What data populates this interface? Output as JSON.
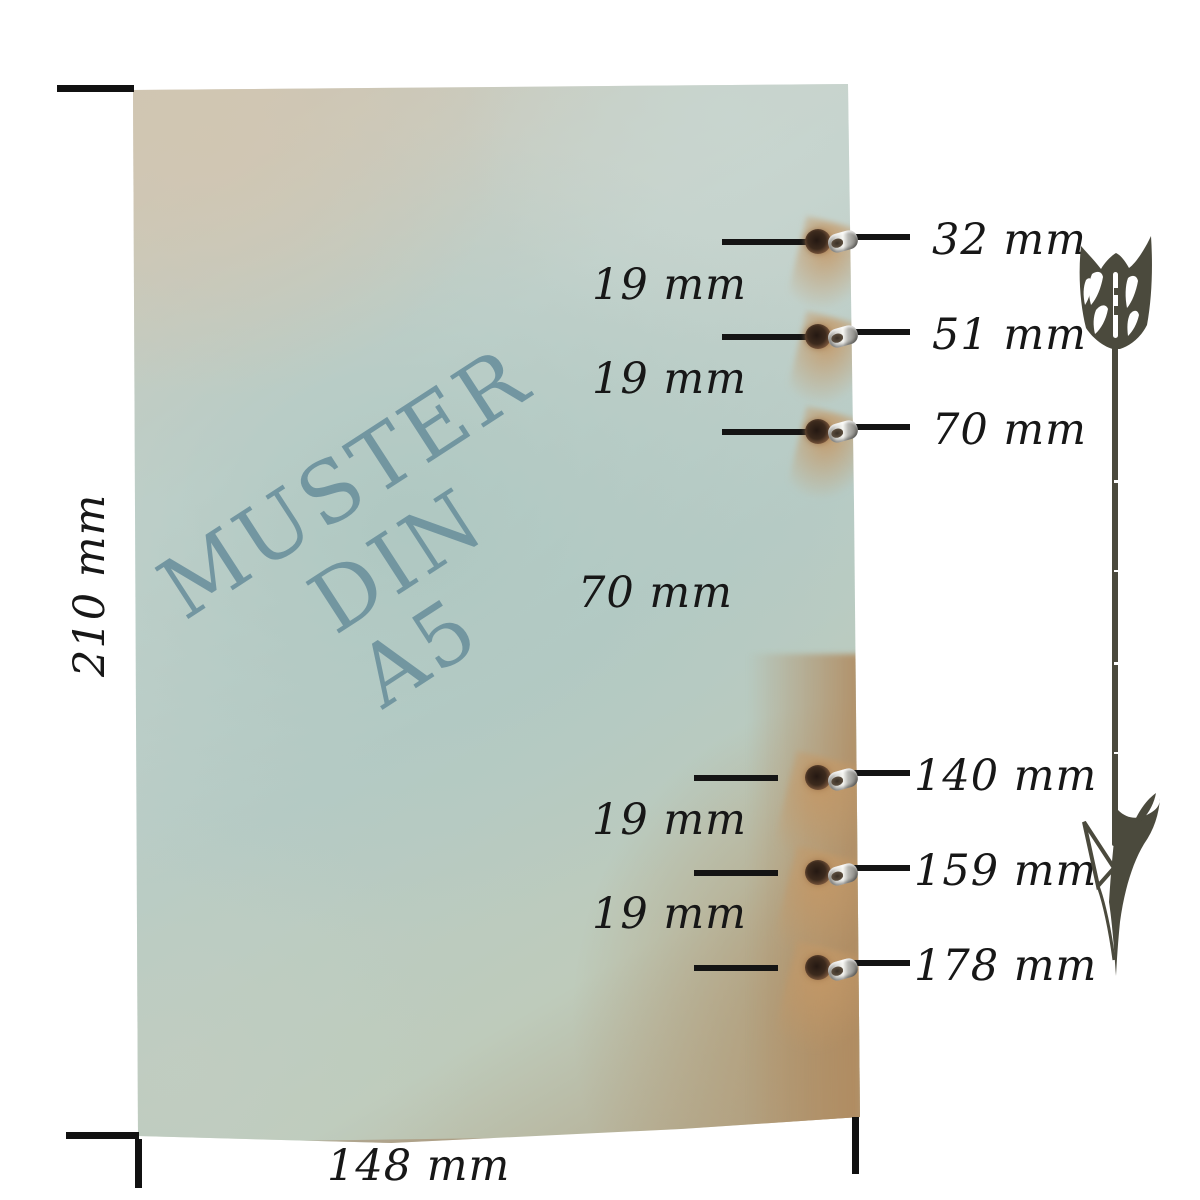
{
  "paper": {
    "watermark": {
      "line1": "MUSTER",
      "line2": "DIN A5"
    },
    "watermark_color": "#6d929e",
    "base_color_top": "#cdc3b0",
    "base_color_middle": "#b7cbc5",
    "base_color_bottom_right": "#b2a284"
  },
  "measurements": {
    "height": "210 mm",
    "width": "148 mm",
    "holes": [
      "32 mm",
      "51 mm",
      "70 mm",
      "140 mm",
      "159 mm",
      "178 mm"
    ],
    "spacings": [
      "19 mm",
      "19 mm",
      "70 mm",
      "19 mm",
      "19 mm"
    ]
  },
  "colors": {
    "dimension_text": "#171717",
    "dimension_line": "#141414",
    "arrow": "#4b4a3d"
  }
}
